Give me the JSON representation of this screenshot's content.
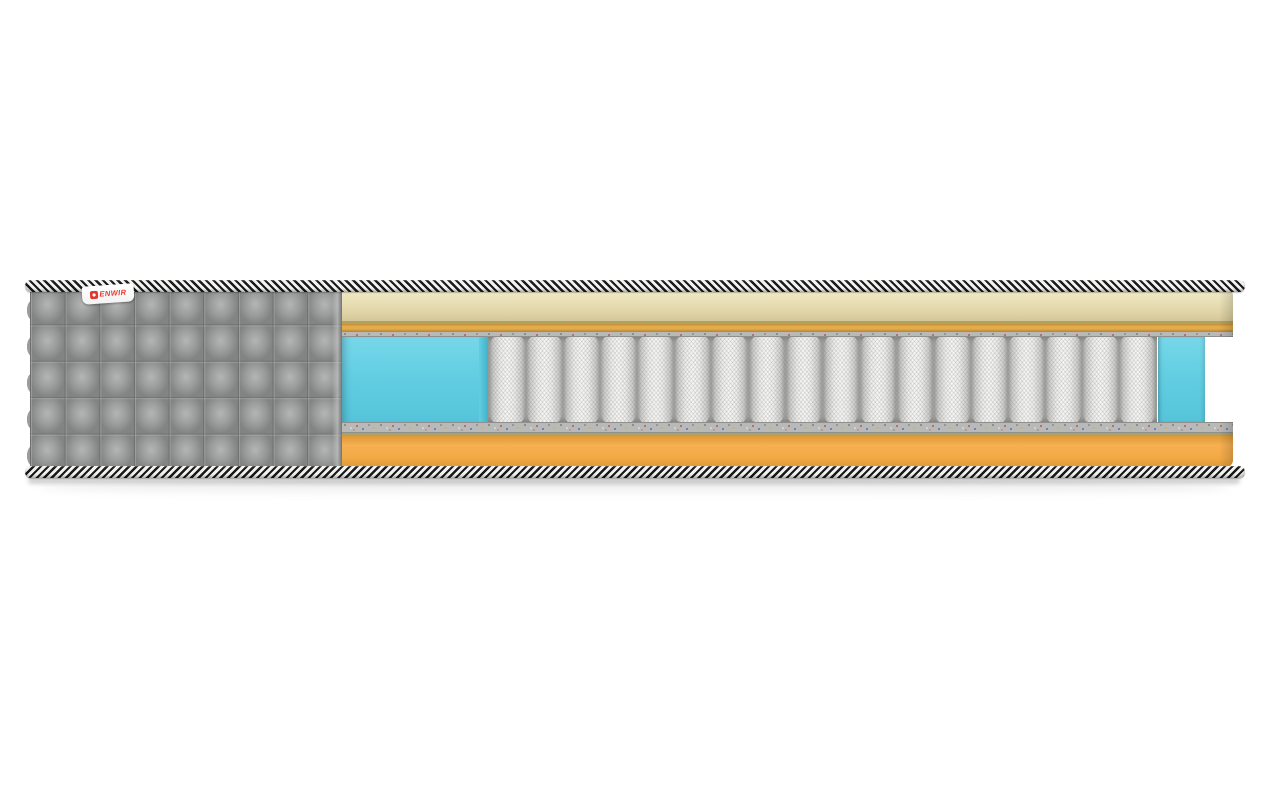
{
  "meta": {
    "description": "Cutaway 3D product render of a mattress: quilted grey cover on the left, cross-section showing cream comfort layer, gold foam strip, speckled felt pads, turquoise perimeter foam, white pocket-spring core and orange base foam, edged top and bottom with black-and-white braided rope tape",
    "background": "#ffffff"
  },
  "brand_tag": {
    "text": "ENWIR"
  },
  "structure": {
    "spring_count": 18,
    "quilt_columns": 9,
    "quilt_rows": 5,
    "layers_top_to_bottom": [
      "edge-braid-top",
      "quilted-cover",
      "cream-comfort-layer",
      "tan-seam-line",
      "gold-foam-strip",
      "felt-pad-top",
      "blue-perimeter-foam-left",
      "pocket-spring-core",
      "blue-perimeter-foam-right",
      "felt-pad-bottom",
      "tan-seam-line",
      "orange-base-foam",
      "edge-braid-bottom"
    ]
  },
  "colors": {
    "background": "#ffffff",
    "braid_dark": "#1a1a1a",
    "braid_light": "#f2f2f0",
    "cover_gray": "#9b9c9c",
    "cover_gray_light": "#b4b5b5",
    "cover_gray_dark": "#828383",
    "cream": "#e8dfb4",
    "cream_light": "#f0e9c6",
    "cream_dark": "#d3c697",
    "tan_line": "#b2a05f",
    "gold": "#e3ab4c",
    "gold_dark": "#c18f36",
    "felt": "#b9b9b7",
    "felt_line": "#8f8f8d",
    "foam_blue": "#63cee2",
    "foam_blue_light": "#76d7e9",
    "foam_blue_dark": "#3fb3cb",
    "spring_light": "#f6f6f4",
    "spring_mid": "#cccccb",
    "spring_dark": "#a7a7a5",
    "orange": "#f2a945",
    "orange_light": "#f6b052",
    "orange_dark": "#df9937",
    "brand_red": "#e2372f",
    "tag_bg": "#ffffff"
  }
}
